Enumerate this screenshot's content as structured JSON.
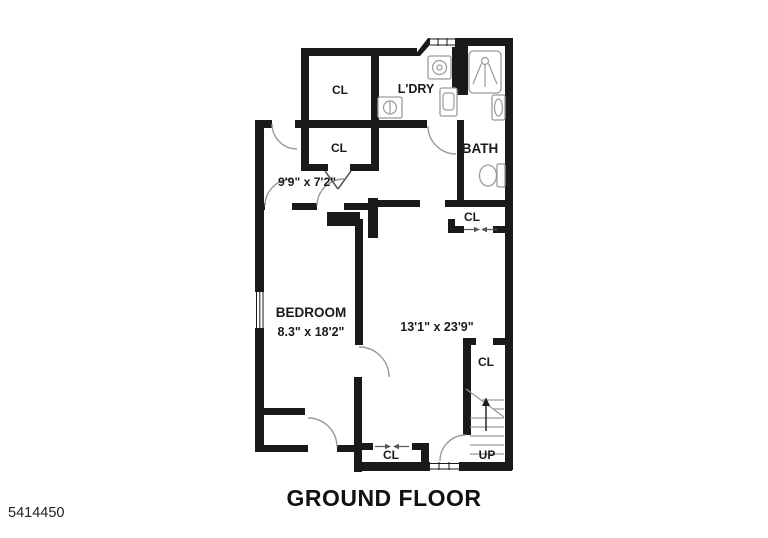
{
  "floorplan": {
    "title": "GROUND FLOOR",
    "listing_id": "5414450",
    "rooms": {
      "closet_top": {
        "label": "CL"
      },
      "laundry": {
        "label": "L'DRY"
      },
      "bath": {
        "label": "BATH"
      },
      "closet_mid": {
        "label": "CL"
      },
      "room_small": {
        "dims": "9'9\" x 7'2\""
      },
      "closet_hall": {
        "label": "CL"
      },
      "bedroom": {
        "label": "BEDROOM",
        "dims": "8.3\" x 18'2\""
      },
      "living": {
        "dims": "13'1\" x 23'9\""
      },
      "closet_entry": {
        "label": "CL"
      },
      "closet_stairs": {
        "label": "CL"
      },
      "stairs": {
        "label": "UP"
      }
    },
    "colors": {
      "wall": "#1a1a1a",
      "fixture": "#9a9a9a",
      "background": "#ffffff"
    }
  }
}
